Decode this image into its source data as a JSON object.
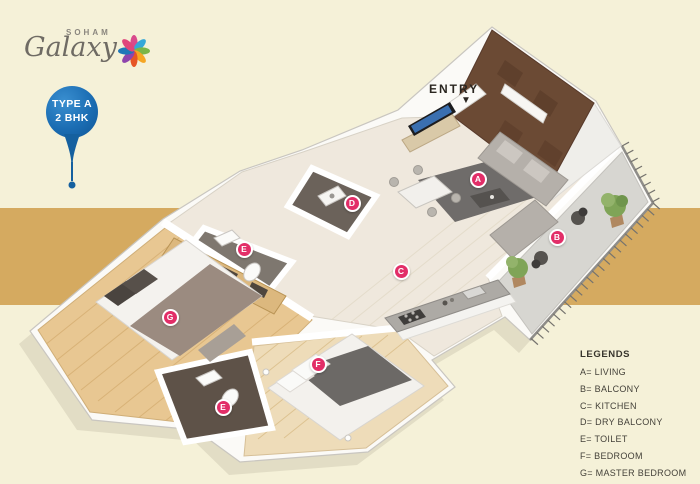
{
  "brand": {
    "top": "SOHAM",
    "script": "Galaxy"
  },
  "badge": {
    "line1": "TYPE A",
    "line2": "2 BHK"
  },
  "entry": {
    "label": "ENTRY",
    "arrow": "▼"
  },
  "legend": {
    "title": "LEGENDS",
    "separator": "=",
    "items": [
      {
        "key": "A",
        "label": "LIVING"
      },
      {
        "key": "B",
        "label": "BALCONY"
      },
      {
        "key": "C",
        "label": "KITCHEN"
      },
      {
        "key": "D",
        "label": "DRY BALCONY"
      },
      {
        "key": "E",
        "label": "TOILET"
      },
      {
        "key": "F",
        "label": "BEDROOM"
      },
      {
        "key": "G",
        "label": "MASTER BEDROOM"
      }
    ]
  },
  "markers": [
    {
      "letter": "A",
      "room": "LIVING",
      "x": 478,
      "y": 179
    },
    {
      "letter": "B",
      "room": "BALCONY",
      "x": 557,
      "y": 237
    },
    {
      "letter": "C",
      "room": "KITCHEN",
      "x": 401,
      "y": 271
    },
    {
      "letter": "D",
      "room": "DRY BALCONY",
      "x": 352,
      "y": 203
    },
    {
      "letter": "E",
      "room": "TOILET",
      "x": 244,
      "y": 249
    },
    {
      "letter": "E",
      "room": "TOILET",
      "x": 223,
      "y": 407
    },
    {
      "letter": "F",
      "room": "BEDROOM",
      "x": 318,
      "y": 364
    },
    {
      "letter": "G",
      "room": "MASTER BEDROOM",
      "x": 170,
      "y": 317
    }
  ],
  "colors": {
    "background": "#f5f1d8",
    "band": "#d5aa60",
    "badge_blue": "#1b6db3",
    "marker_pink": "#e22e68",
    "accent_wall": "#6b4a34",
    "text_dark": "#37342c",
    "logo_gray": "#6f6b64"
  }
}
